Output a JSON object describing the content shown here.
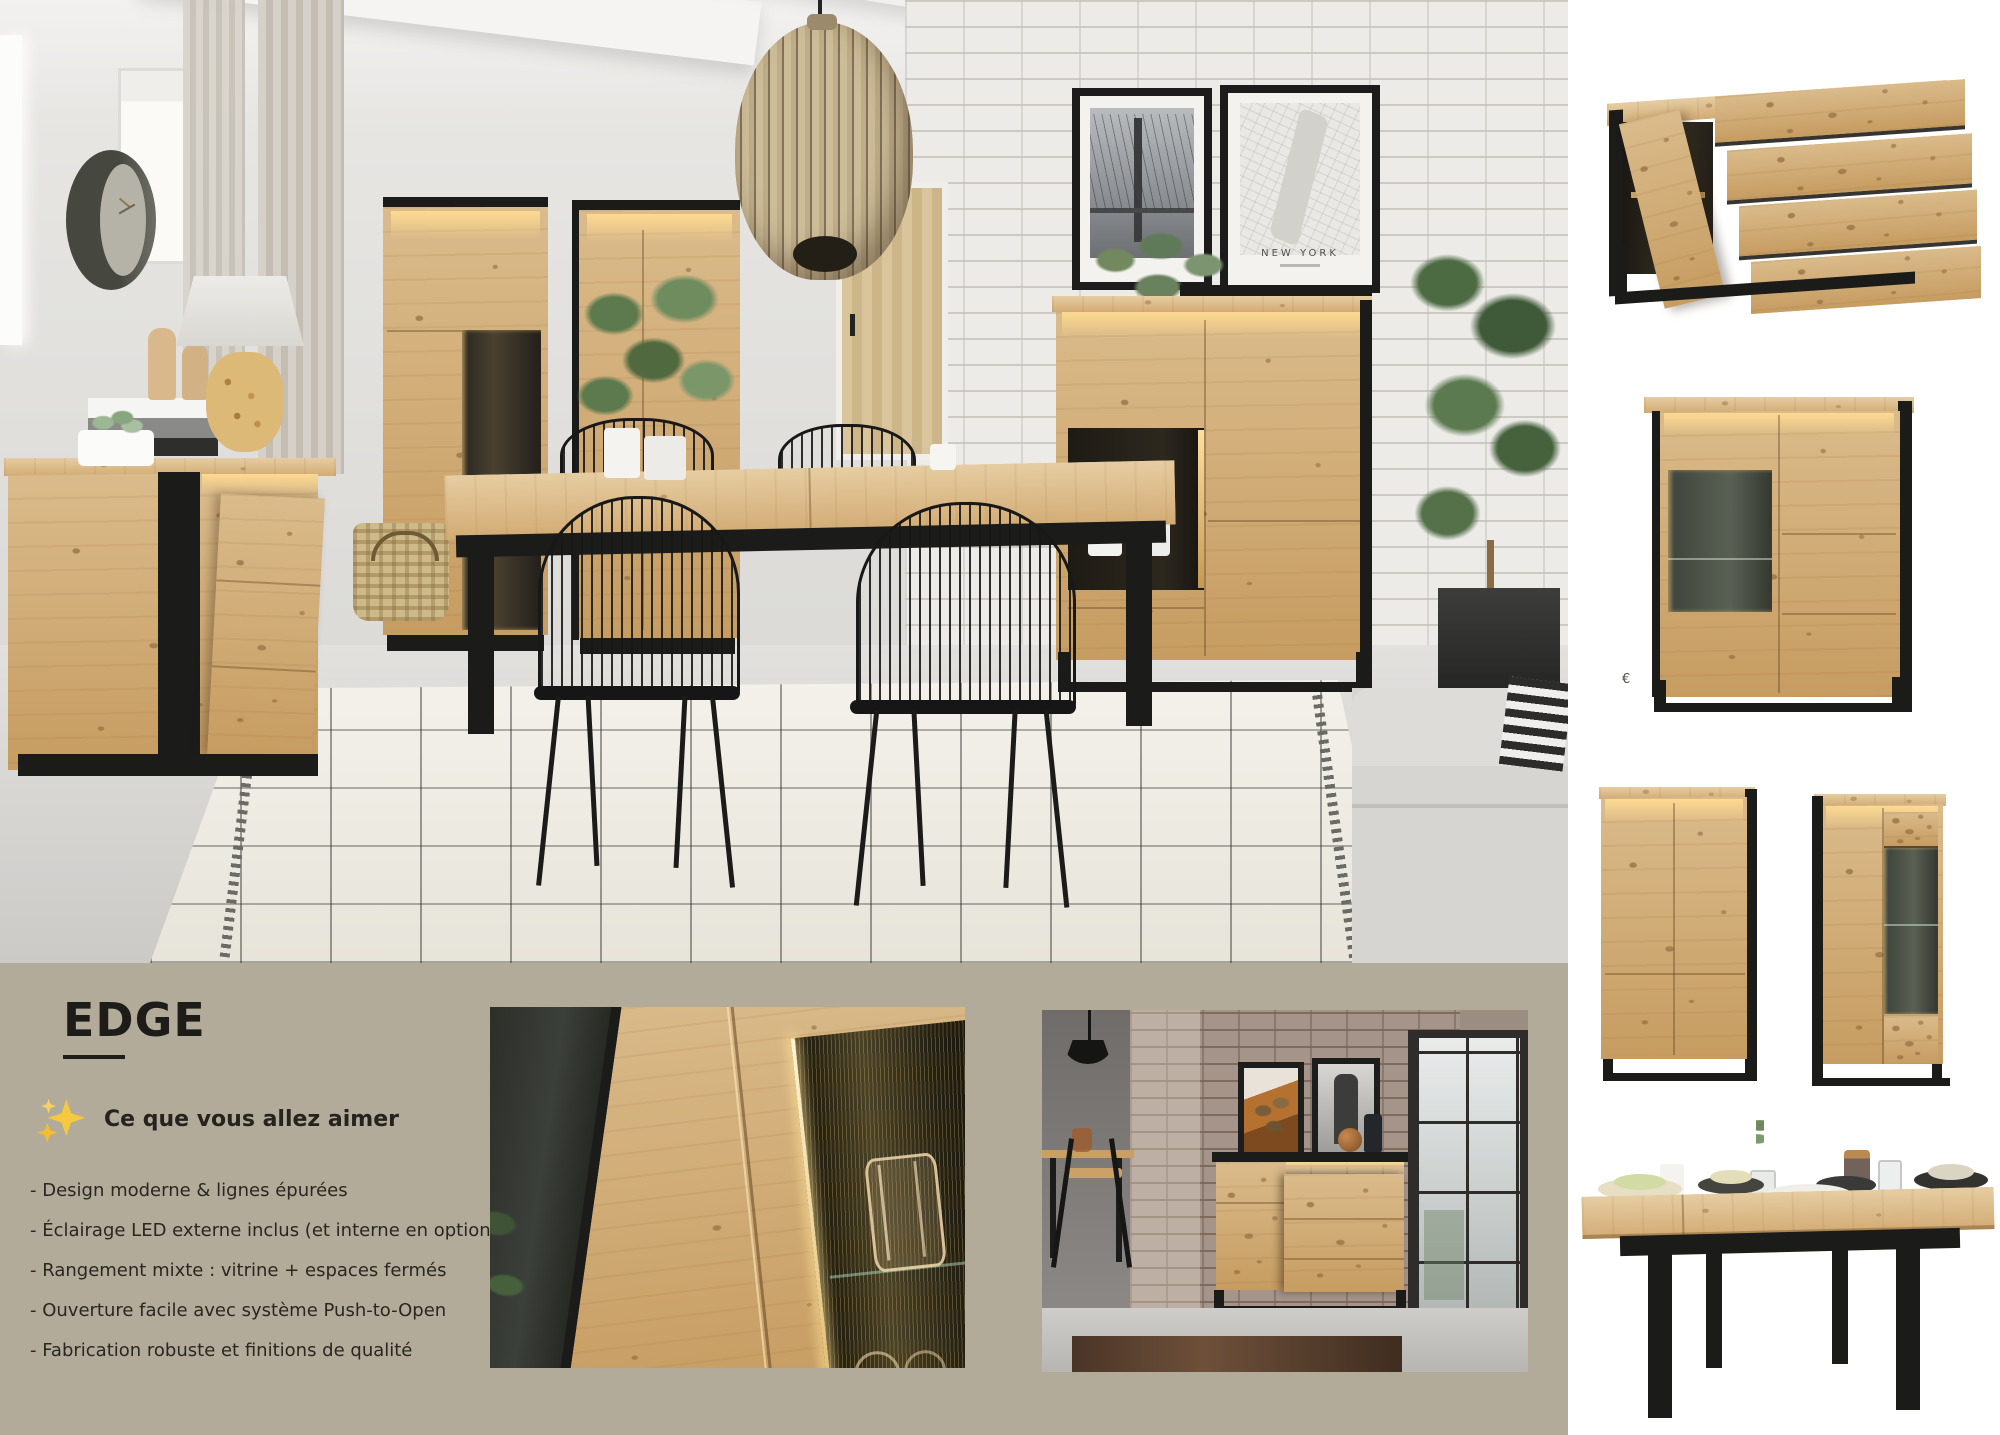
{
  "panel": {
    "title": "EDGE",
    "heading": "Ce que vous allez aimer",
    "features": [
      "- Design moderne & lignes épurées",
      "- Éclairage LED externe inclus (et interne en option)",
      "- Rangement mixte : vitrine + espaces fermés",
      "- Ouverture facile avec système Push-to-Open",
      "- Fabrication robuste et finitions de qualité"
    ],
    "sparkles_icon": "sparkles-icon"
  },
  "main_photo": {
    "poster_title": "NEW YORK"
  },
  "products": {
    "price_symbol": "€"
  },
  "colors": {
    "panel_bg": "#b2ab9a",
    "wood": "#cfa56c",
    "wood_light": "#e3c79a",
    "metal_black": "#1b1b1a",
    "led_glow": "#ffd98f",
    "text": "#26231e",
    "page_bg": "#ffffff"
  }
}
